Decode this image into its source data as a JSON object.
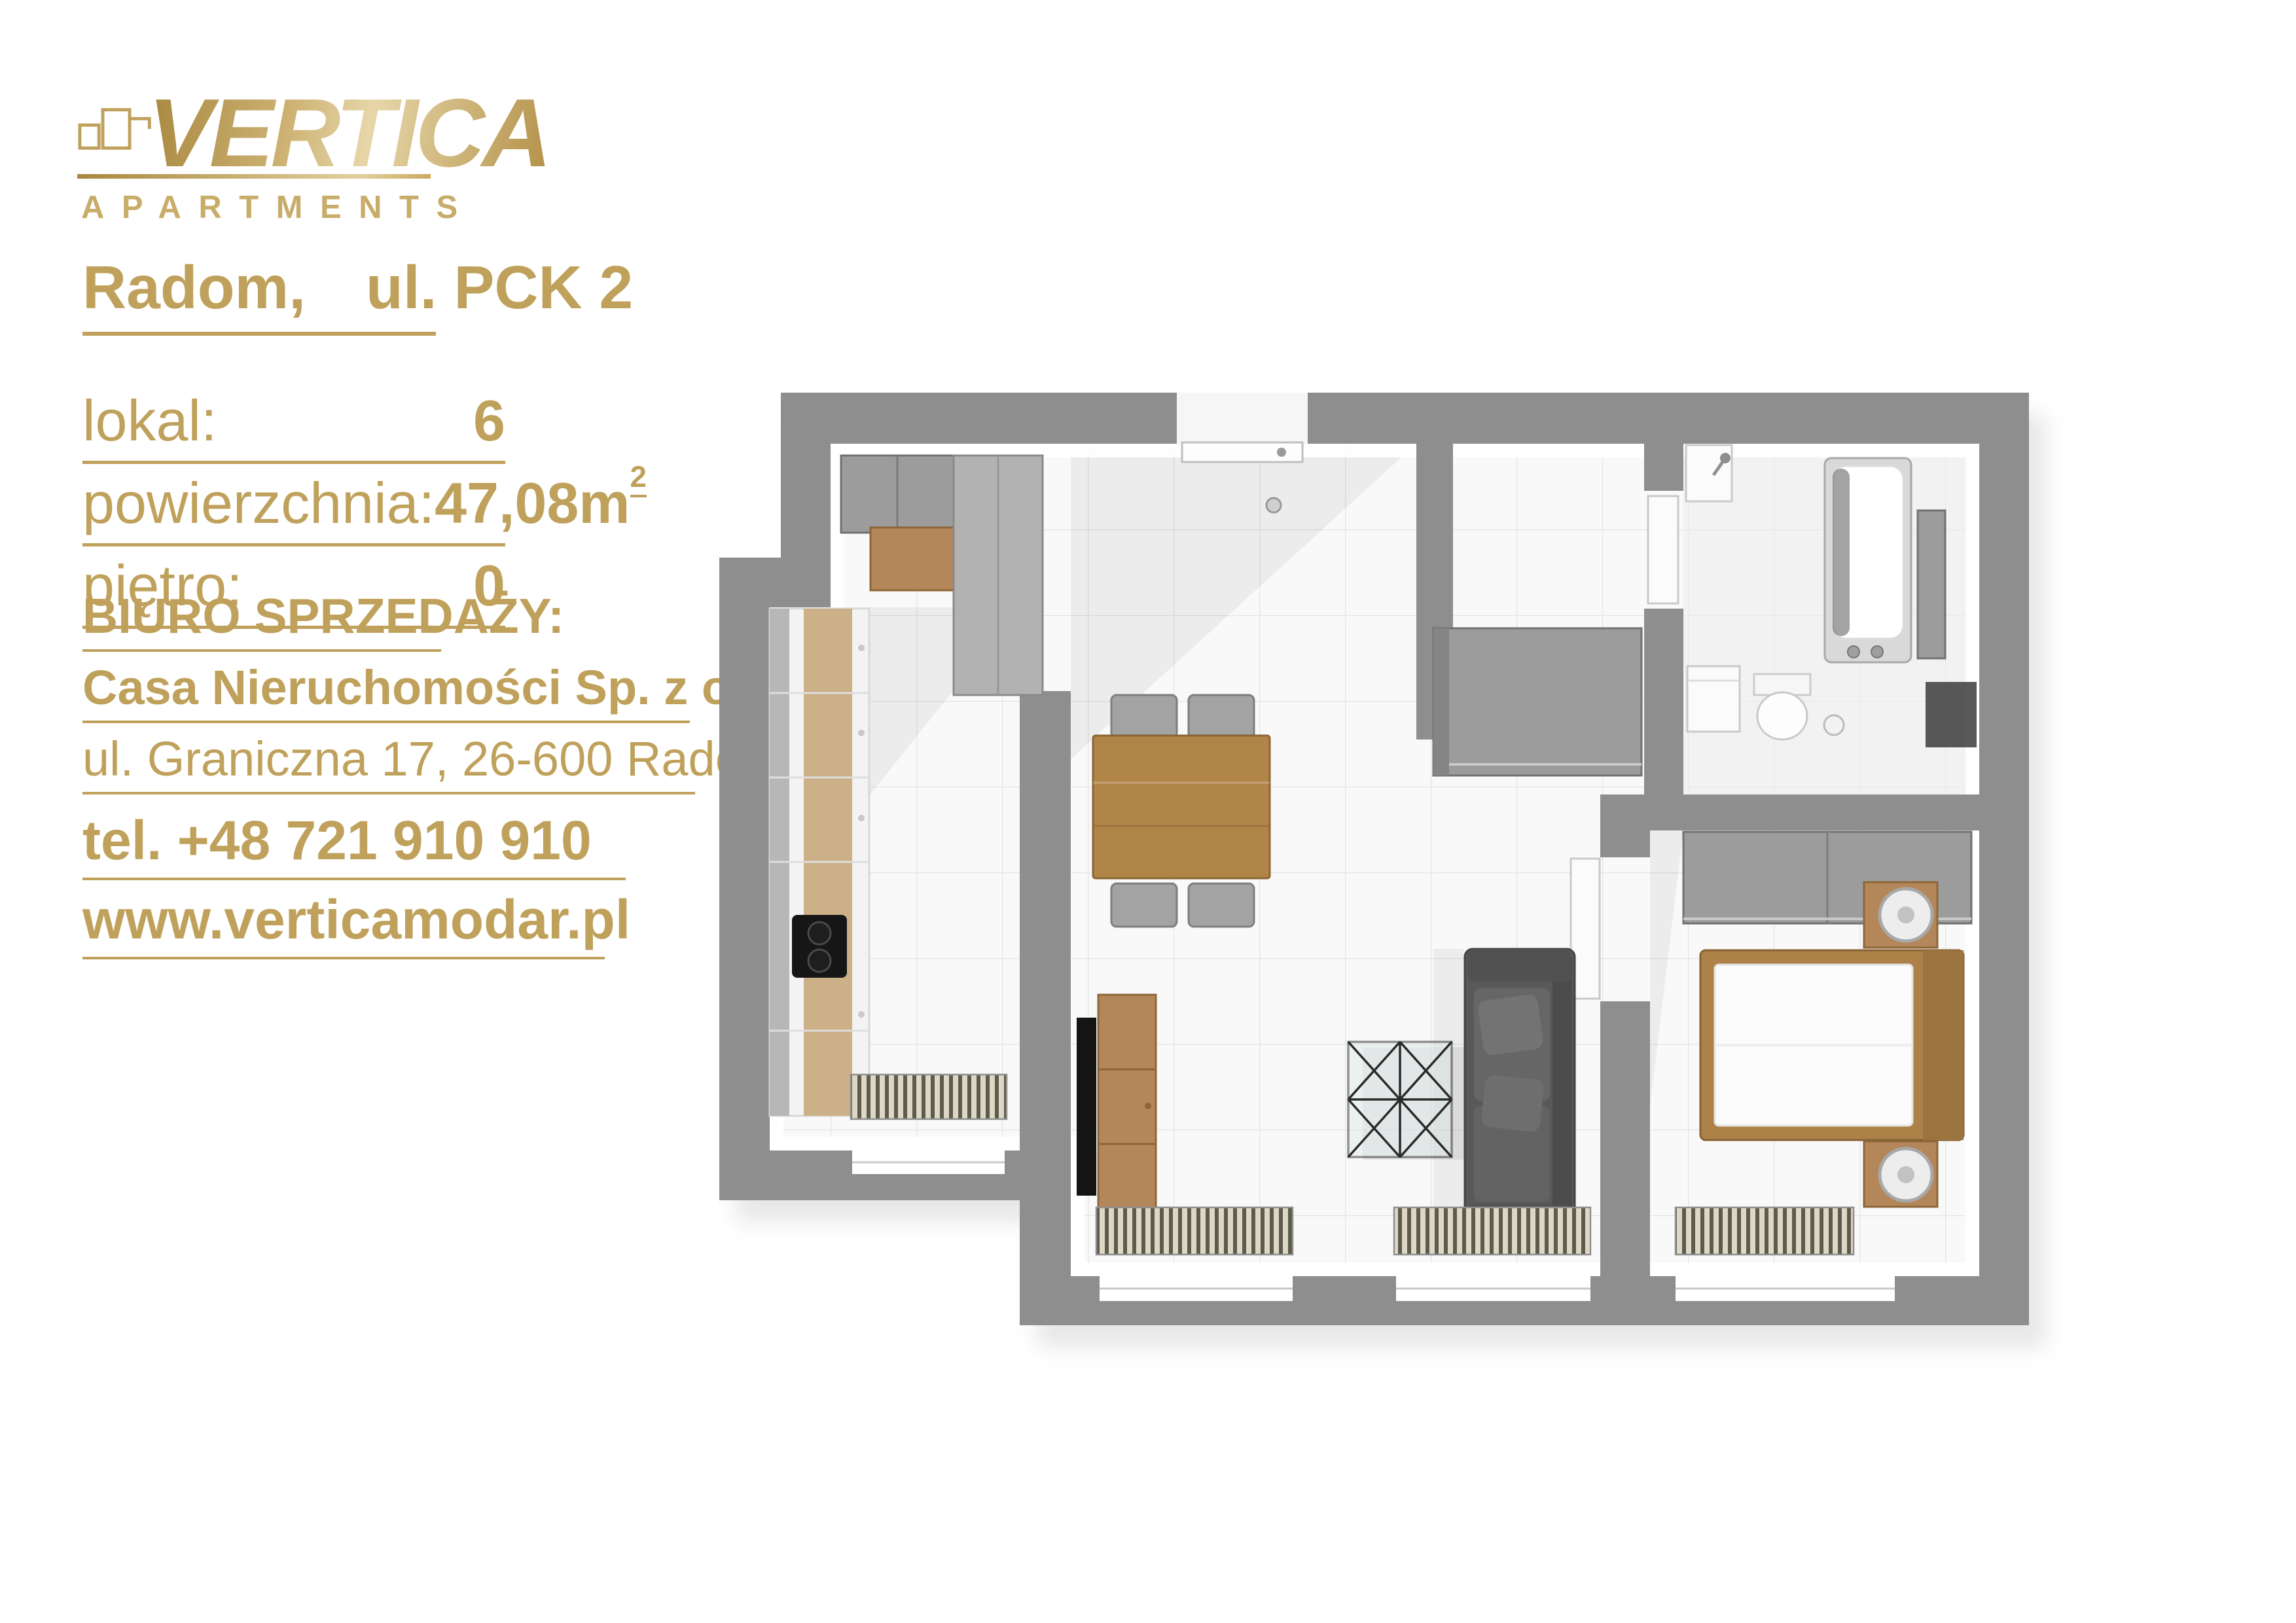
{
  "theme": {
    "gold": "#bfa15c",
    "gold-light": "#dfca96",
    "gold-deep": "#a8883f",
    "wall": "#8e8e8e",
    "floor": "#f9f9f9",
    "wood": "#b4875a",
    "wood-dark": "#b18548",
    "wood-light": "#ccb088",
    "sofa": "#595959"
  },
  "logo": {
    "brand": "VERTICA",
    "tagline": "APARTMENTS"
  },
  "listing": {
    "city": "Radom,",
    "street": "ul. PCK 2"
  },
  "details": {
    "rows": [
      {
        "label": "lokal:",
        "value": "6",
        "sup": ""
      },
      {
        "label": "powierzchnia:",
        "value": "47,08m",
        "sup": "2"
      },
      {
        "label": "piętro:",
        "value": "0",
        "sup": ""
      }
    ]
  },
  "sales_office": {
    "heading": "BIURO SPRZEDAŻY:",
    "company": "Casa Nieruchomości Sp. z o. o.",
    "address": "ul. Graniczna 17, 26-600 Radom",
    "phone_label": "tel.",
    "phone": "+48 721 910 910",
    "website": "www.verticamodar.pl"
  },
  "floorplan": {
    "view": "3d-top-down-render",
    "rooms": [
      "kitchen",
      "living-dining-room",
      "hall",
      "bathroom",
      "bedroom"
    ],
    "furniture": [
      "kitchen-cabinets",
      "cooktop",
      "dining-table",
      "chairs",
      "tv-stand",
      "tv",
      "coffee-table",
      "sofa",
      "radiators",
      "entrance-door",
      "hall-cabinet",
      "sink",
      "washing-machine",
      "toilet",
      "bathtub",
      "wardrobe",
      "bed",
      "nightstands",
      "lamps"
    ]
  }
}
